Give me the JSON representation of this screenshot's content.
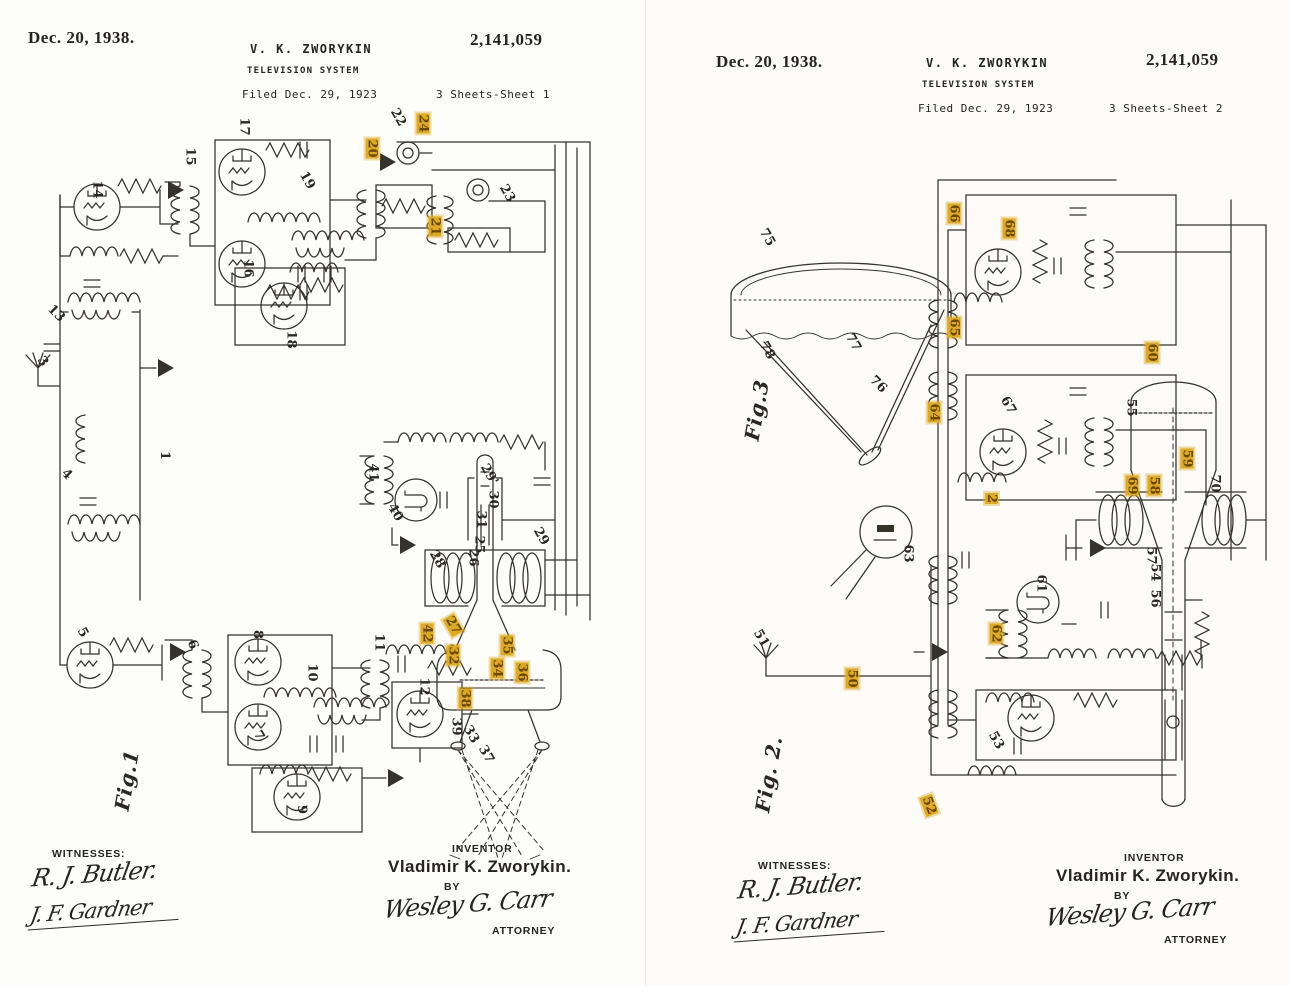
{
  "document_type": "patent-drawing-scan",
  "ink_color": "#35322c",
  "accent_color": "#dcaa25",
  "pages": [
    {
      "header": {
        "date": "Dec. 20, 1938.",
        "inventor_name": "V. K. ZWORYKIN",
        "doc_title": "TELEVISION SYSTEM",
        "filed": "Filed Dec. 29, 1923",
        "patent_number": "2,141,059",
        "sheet": "3 Sheets-Sheet 1"
      },
      "figure_labels": [
        {
          "t": "Fig.1",
          "x": 96,
          "y": 768,
          "r": -80
        }
      ],
      "ref_labels": [
        {
          "t": "14",
          "x": 88,
          "y": 183
        },
        {
          "t": "15",
          "x": 181,
          "y": 150
        },
        {
          "t": "17",
          "x": 235,
          "y": 120
        },
        {
          "t": "16",
          "x": 239,
          "y": 262
        },
        {
          "t": "18",
          "x": 282,
          "y": 333
        },
        {
          "t": "19",
          "x": 298,
          "y": 174,
          "r": 60
        },
        {
          "t": "20",
          "x": 362,
          "y": 142,
          "a": 1
        },
        {
          "t": "22",
          "x": 389,
          "y": 111,
          "r": 60
        },
        {
          "t": "24",
          "x": 413,
          "y": 117,
          "a": 1
        },
        {
          "t": "21",
          "x": 425,
          "y": 220,
          "a": 1
        },
        {
          "t": "23",
          "x": 498,
          "y": 187,
          "r": 60
        },
        {
          "t": "13",
          "x": 47,
          "y": 307,
          "r": 45
        },
        {
          "t": "3",
          "x": 38,
          "y": 355,
          "r": 55
        },
        {
          "t": "1",
          "x": 160,
          "y": 449
        },
        {
          "t": "4",
          "x": 62,
          "y": 468,
          "r": 45
        },
        {
          "t": "41",
          "x": 364,
          "y": 466
        },
        {
          "t": "40",
          "x": 386,
          "y": 506,
          "r": 60
        },
        {
          "t": "29'",
          "x": 478,
          "y": 468,
          "r": 60
        },
        {
          "t": "30",
          "x": 484,
          "y": 493
        },
        {
          "t": "31",
          "x": 472,
          "y": 513
        },
        {
          "t": "25",
          "x": 470,
          "y": 538
        },
        {
          "t": "26",
          "x": 464,
          "y": 551
        },
        {
          "t": "28",
          "x": 428,
          "y": 553,
          "r": 60
        },
        {
          "t": "29",
          "x": 532,
          "y": 530,
          "r": 60
        },
        {
          "t": "5",
          "x": 78,
          "y": 626,
          "r": 60
        },
        {
          "t": "6",
          "x": 188,
          "y": 638,
          "r": 70
        },
        {
          "t": "8",
          "x": 253,
          "y": 628
        },
        {
          "t": "10",
          "x": 303,
          "y": 666
        },
        {
          "t": "11",
          "x": 370,
          "y": 636
        },
        {
          "t": "7",
          "x": 254,
          "y": 729,
          "r": 60
        },
        {
          "t": "9",
          "x": 297,
          "y": 803
        },
        {
          "t": "42",
          "x": 417,
          "y": 627,
          "a": 1
        },
        {
          "t": "27",
          "x": 443,
          "y": 619,
          "a": 1,
          "r": 60
        },
        {
          "t": "32",
          "x": 443,
          "y": 649,
          "a": 1
        },
        {
          "t": "35",
          "x": 497,
          "y": 639,
          "a": 1
        },
        {
          "t": "34",
          "x": 487,
          "y": 662,
          "a": 1
        },
        {
          "t": "36",
          "x": 512,
          "y": 666,
          "a": 1
        },
        {
          "t": "38",
          "x": 455,
          "y": 692,
          "a": 1
        },
        {
          "t": "12",
          "x": 415,
          "y": 680
        },
        {
          "t": "39",
          "x": 447,
          "y": 720
        },
        {
          "t": "33",
          "x": 462,
          "y": 728,
          "r": 60
        },
        {
          "t": "37",
          "x": 477,
          "y": 748,
          "r": 60
        }
      ],
      "footer": {
        "witnesses_label": "WITNESSES:",
        "witness_1": "R. J. Butler.",
        "witness_2": "J. F. Gardner",
        "inventor_label": "INVENTOR",
        "inventor_signature": "Vladimir K. Zworykin.",
        "by_label": "BY",
        "attorney_signature": "Wesley G. Carr",
        "attorney_label": "ATTORNEY"
      }
    },
    {
      "header": {
        "date": "Dec. 20, 1938.",
        "inventor_name": "V. K. ZWORYKIN",
        "doc_title": "TELEVISION SYSTEM",
        "filed": "Filed Dec. 29, 1923",
        "patent_number": "2,141,059",
        "sheet": "3 Sheets-Sheet 2"
      },
      "figure_labels": [
        {
          "t": "Fig.3",
          "x": 80,
          "y": 398,
          "r": -80
        },
        {
          "t": "Fig. 2.",
          "x": 84,
          "y": 762,
          "r": -80
        }
      ],
      "ref_labels": [
        {
          "t": "75",
          "x": 112,
          "y": 231,
          "r": 60
        },
        {
          "t": "78",
          "x": 112,
          "y": 344,
          "r": 60
        },
        {
          "t": "77",
          "x": 198,
          "y": 336,
          "r": 60
        },
        {
          "t": "76",
          "x": 223,
          "y": 378,
          "r": 45
        },
        {
          "t": "66",
          "x": 298,
          "y": 207,
          "a": 1
        },
        {
          "t": "68",
          "x": 353,
          "y": 222,
          "a": 1
        },
        {
          "t": "65",
          "x": 298,
          "y": 321,
          "a": 1
        },
        {
          "t": "64",
          "x": 278,
          "y": 406,
          "a": 1
        },
        {
          "t": "67",
          "x": 353,
          "y": 399,
          "r": 60
        },
        {
          "t": "60",
          "x": 496,
          "y": 346,
          "a": 1
        },
        {
          "t": "55",
          "x": 476,
          "y": 401
        },
        {
          "t": "59",
          "x": 531,
          "y": 452,
          "a": 1
        },
        {
          "t": "69",
          "x": 476,
          "y": 479,
          "a": 1
        },
        {
          "t": "58",
          "x": 498,
          "y": 479,
          "a": 1
        },
        {
          "t": "70",
          "x": 560,
          "y": 477
        },
        {
          "t": "57",
          "x": 496,
          "y": 549
        },
        {
          "t": "54",
          "x": 500,
          "y": 566
        },
        {
          "t": "56",
          "x": 500,
          "y": 592
        },
        {
          "t": "2",
          "x": 340,
          "y": 492,
          "a": 1
        },
        {
          "t": "63",
          "x": 253,
          "y": 547
        },
        {
          "t": "61",
          "x": 386,
          "y": 577
        },
        {
          "t": "62",
          "x": 340,
          "y": 627,
          "a": 1
        },
        {
          "t": "51",
          "x": 106,
          "y": 632,
          "r": 60
        },
        {
          "t": "50",
          "x": 196,
          "y": 672,
          "a": 1
        },
        {
          "t": "53",
          "x": 341,
          "y": 734,
          "r": 60
        },
        {
          "t": "52",
          "x": 273,
          "y": 799,
          "a": 1,
          "r": 70
        }
      ],
      "footer": {
        "witnesses_label": "WITNESSES:",
        "witness_1": "R. J. Butler.",
        "witness_2": "J. F. Gardner",
        "inventor_label": "INVENTOR",
        "inventor_signature": "Vladimir K. Zworykin.",
        "by_label": "BY",
        "attorney_signature": "Wesley G. Carr",
        "attorney_label": "ATTORNEY"
      }
    }
  ]
}
